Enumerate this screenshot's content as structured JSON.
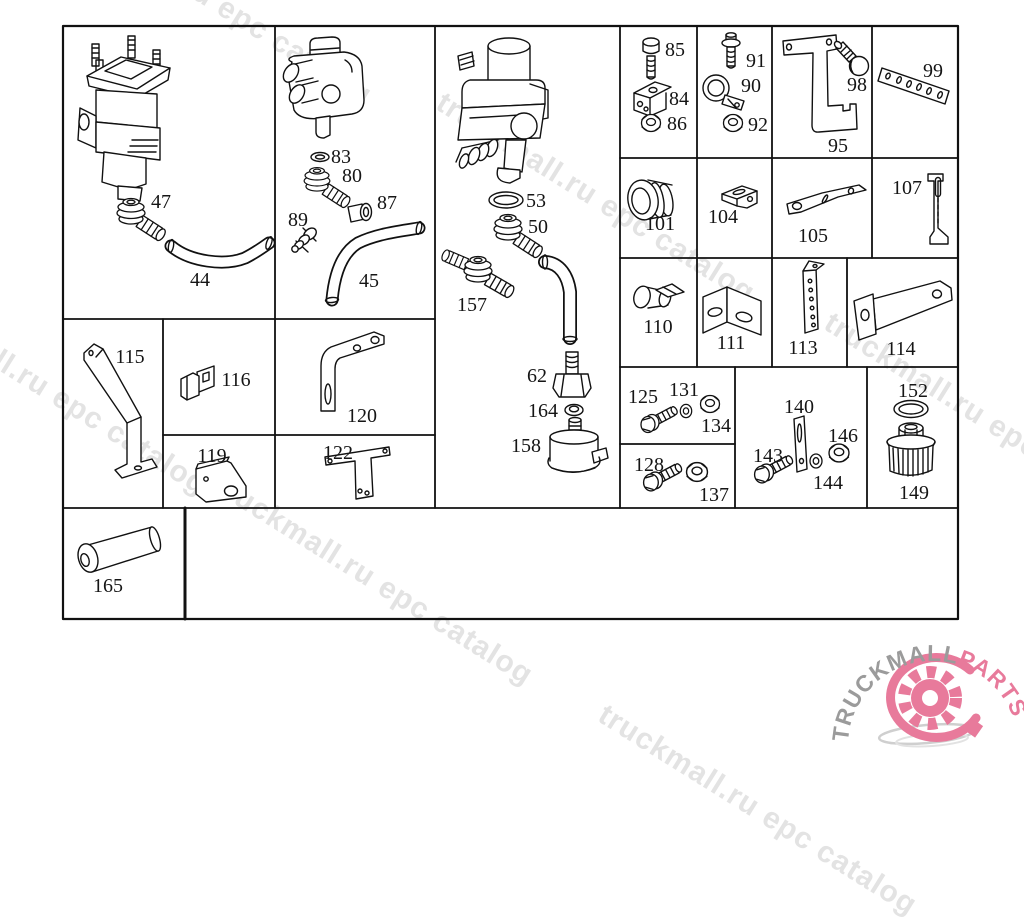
{
  "watermark": {
    "text": "truckmall.ru epc catalog",
    "color": "#e3e3e3"
  },
  "logo": {
    "brand": "TRUCKMALL",
    "accent": "PARTS",
    "brand_color": "#9b9b9b",
    "accent_color": "#e87a9b"
  },
  "labels": {
    "n44": "44",
    "n45": "45",
    "n47": "47",
    "n50": "50",
    "n53": "53",
    "n62": "62",
    "n80": "80",
    "n83": "83",
    "n84": "84",
    "n85": "85",
    "n86": "86",
    "n87": "87",
    "n89": "89",
    "n90": "90",
    "n91": "91",
    "n92": "92",
    "n95": "95",
    "n98": "98",
    "n99": "99",
    "n101": "101",
    "n104": "104",
    "n105": "105",
    "n107": "107",
    "n110": "110",
    "n111": "111",
    "n113": "113",
    "n114": "114",
    "n115": "115",
    "n116": "116",
    "n119": "119",
    "n120": "120",
    "n122": "122",
    "n125": "125",
    "n128": "128",
    "n131": "131",
    "n134": "134",
    "n137": "137",
    "n140": "140",
    "n143": "143",
    "n144": "144",
    "n146": "146",
    "n149": "149",
    "n152": "152",
    "n157": "157",
    "n158": "158",
    "n164": "164",
    "n165": "165"
  }
}
